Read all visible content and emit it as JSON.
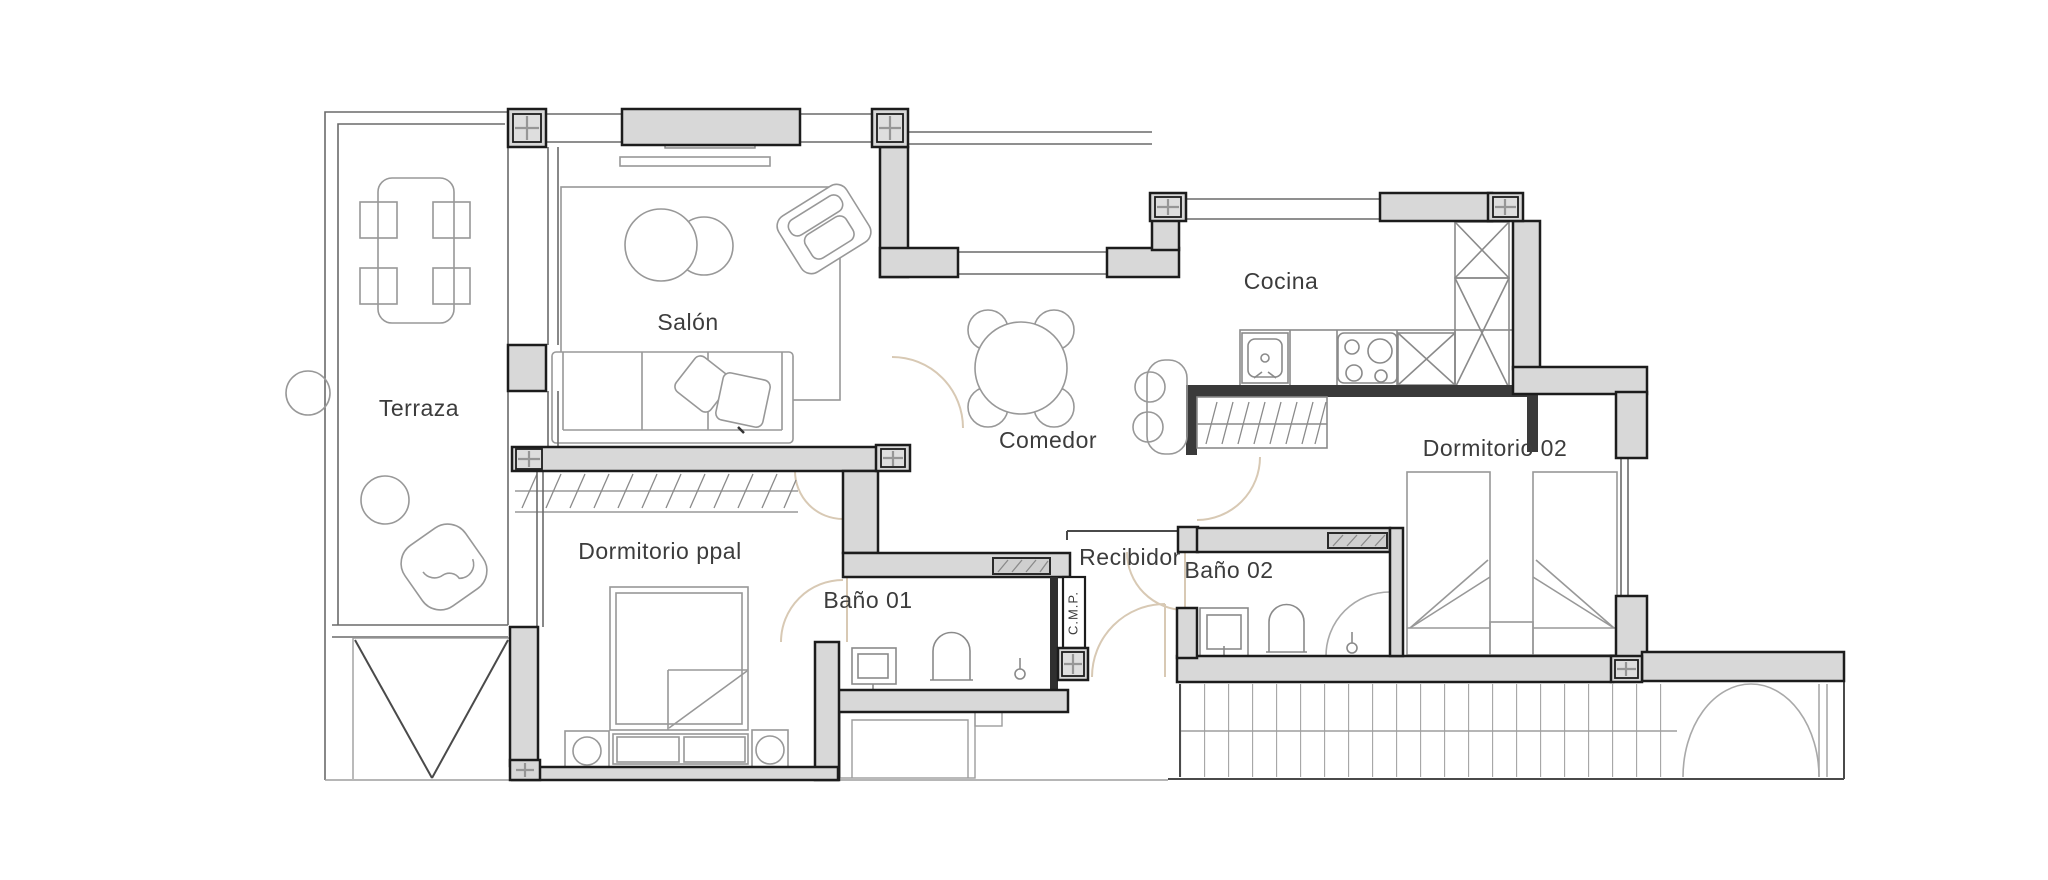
{
  "palette": {
    "background": "#ffffff",
    "wall_fill": "#d8d8d8",
    "wall_stroke": "#1c1c1c",
    "partition_fill": "#2f2f2f",
    "bar_fill": "#3a3a3a",
    "column_inner": "#dedede",
    "plus_mark": "#969696",
    "glass_stroke": "#6a6a6a",
    "furniture_stroke": "#989898",
    "fixture_stroke": "#8a8a8a",
    "hatch_fill": "#cfcfcf",
    "door_arc": "#d8c9b4",
    "label_color": "#3c3c3c"
  },
  "rooms": [
    {
      "id": "terraza",
      "label": "Terraza"
    },
    {
      "id": "salon",
      "label": "Salón"
    },
    {
      "id": "comedor",
      "label": "Comedor"
    },
    {
      "id": "cocina",
      "label": "Cocina"
    },
    {
      "id": "dormitorio-ppal",
      "label": "Dormitorio ppal"
    },
    {
      "id": "bano-01",
      "label": "Baño 01"
    },
    {
      "id": "recibidor",
      "label": "Recibidor"
    },
    {
      "id": "bano-02",
      "label": "Baño 02"
    },
    {
      "id": "dormitorio-02",
      "label": "Dormitorio 02"
    },
    {
      "id": "cmp-closet",
      "label": "C.M.P."
    }
  ]
}
